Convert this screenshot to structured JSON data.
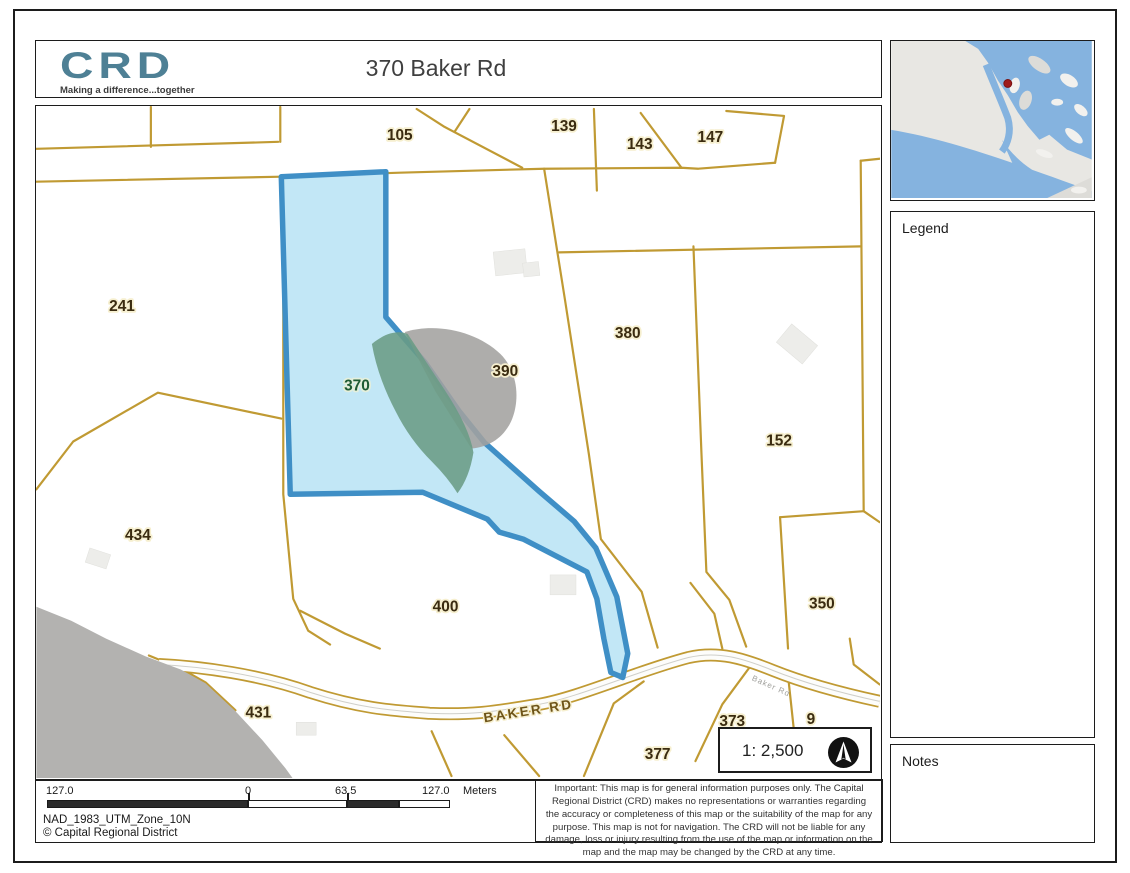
{
  "header": {
    "logo_text": "CRD",
    "logo_tagline": "Making a difference...together",
    "title": "370 Baker Rd"
  },
  "map": {
    "parcels": [
      {
        "label": "105"
      },
      {
        "label": "139"
      },
      {
        "label": "143"
      },
      {
        "label": "147"
      },
      {
        "label": "241"
      },
      {
        "label": "380"
      },
      {
        "label": "390"
      },
      {
        "label": "370"
      },
      {
        "label": "152"
      },
      {
        "label": "434"
      },
      {
        "label": "400"
      },
      {
        "label": "350"
      },
      {
        "label": "431"
      },
      {
        "label": "373"
      },
      {
        "label": "377"
      }
    ],
    "road_label": "BAKER RD",
    "road_label_small": "Baker Rd",
    "partial_label": "9",
    "highlighted_parcel": "370"
  },
  "scale_box": {
    "scale_text": "1: 2,500"
  },
  "legend": {
    "title": "Legend"
  },
  "notes": {
    "title": "Notes"
  },
  "scalebar": {
    "left_label": "127.0",
    "zero_label": "0",
    "mid_label": "63.5",
    "right_label": "127.0",
    "units": "Meters"
  },
  "footer": {
    "datum": "NAD_1983_UTM_Zone_10N",
    "copyright": "© Capital Regional District"
  },
  "disclaimer": {
    "text": "Important: This map is for general information purposes only. The Capital Regional District (CRD) makes no representations or warranties regarding the accuracy or completeness of this map or the suitability of the map for any purpose. This map is not for navigation. The CRD will not be liable for any damage, loss or injury resulting from the use of the map or information on the map and the map may be changed by the CRD at any time."
  },
  "colors": {
    "parcel_line": "#c09a33",
    "highlight_fill": "#b7e3f4",
    "highlight_border": "#3f8fc6",
    "label_halo": "#f6efcf",
    "highlight_label_green": "#1f5c34",
    "shore_gray": "#b3b2b0",
    "rock_gray": "#a3a29f",
    "vegetation_green": "#6a9c85",
    "inset_water": "#85b3df",
    "inset_land": "#e8e7e3",
    "marker_red": "#9e1b1b",
    "logo_teal": "#4e8095"
  }
}
